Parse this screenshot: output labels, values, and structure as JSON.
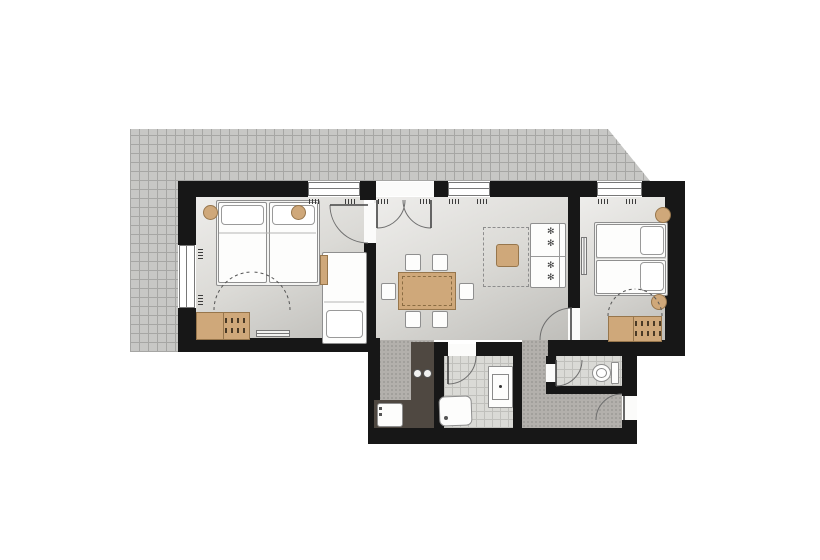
{
  "meta": {
    "kind": "apartment-floor-plan",
    "view": "top-down-2d",
    "no_visible_text": true
  },
  "palette": {
    "background": "#ffffff",
    "wall": "#171717",
    "terrace_tile": "#c7c7c5",
    "tile_grout": "#a6a6a4",
    "room_floor_light": "#eeedeb",
    "room_floor_dark": "#bfbeba",
    "hall_floor": "#b3b0ac",
    "bath_tile": "#dadad6",
    "wood": "#cfa87a",
    "wood_edge": "#97764c",
    "kitchen_counter": "#4f4841",
    "fixture_white": "#fdfdfc",
    "line": "#6e6e6e"
  },
  "icons": {
    "sofa_pillow_glyph": "✻"
  },
  "areas": {
    "terrace": {
      "shape": "L-shaped tiled area, diagonal cut at top-right"
    },
    "rooms": [
      {
        "id": "bedroom-left",
        "furniture": [
          "double-bed",
          "pillow",
          "pillow",
          "nightstand-round",
          "nightstand-round",
          "single-bed",
          "wardrobe-with-hangers",
          "radiator"
        ]
      },
      {
        "id": "living-dining",
        "furniture": [
          "dining-table",
          "chair",
          "chair",
          "chair",
          "chair",
          "chair",
          "chair",
          "sofa",
          "coffee-table",
          "rug-dashed"
        ]
      },
      {
        "id": "kitchen-nook",
        "furniture": [
          "l-shaped-counter",
          "cooktop-2-burners",
          "sink"
        ]
      },
      {
        "id": "bathroom",
        "furniture": [
          "shower",
          "washbasin"
        ]
      },
      {
        "id": "wc",
        "furniture": [
          "toilet"
        ]
      },
      {
        "id": "hallway",
        "furniture": []
      },
      {
        "id": "bedroom-right",
        "furniture": [
          "double-bed",
          "pillow",
          "pillow",
          "nightstand-round",
          "nightstand-round",
          "wardrobe-with-hangers",
          "radiator"
        ]
      }
    ],
    "doors": [
      "bedroom-left-door",
      "living-french-door",
      "bathroom-door",
      "wc-door",
      "entrance-door",
      "bedroom-right-door"
    ],
    "windows": [
      "bedroom-left-top-window",
      "bedroom-left-side-window",
      "living-top-window",
      "bedroom-right-top-window"
    ]
  }
}
